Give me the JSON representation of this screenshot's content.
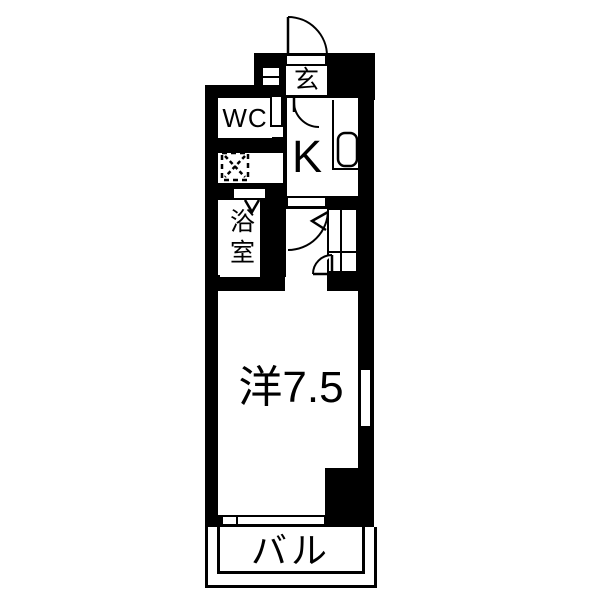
{
  "plan": {
    "type": "japanese-apartment-floor-plan",
    "layout_name": "1K",
    "colors": {
      "wall": "#000000",
      "floor": "#ffffff",
      "line": "#000000"
    },
    "labels": {
      "entrance": "玄",
      "wc": "WC",
      "kitchen": "K",
      "bathroom": "浴室",
      "main_room": "洋7.5",
      "balcony": "バル"
    },
    "fixtures": {
      "sink": "kitchen-sink",
      "washer_pan": "washing-machine-space",
      "shoe_cabinet": "shoe-cabinet",
      "closet": "closet-with-dividers",
      "windows": [
        "right-wall-window",
        "balcony-window"
      ]
    }
  }
}
